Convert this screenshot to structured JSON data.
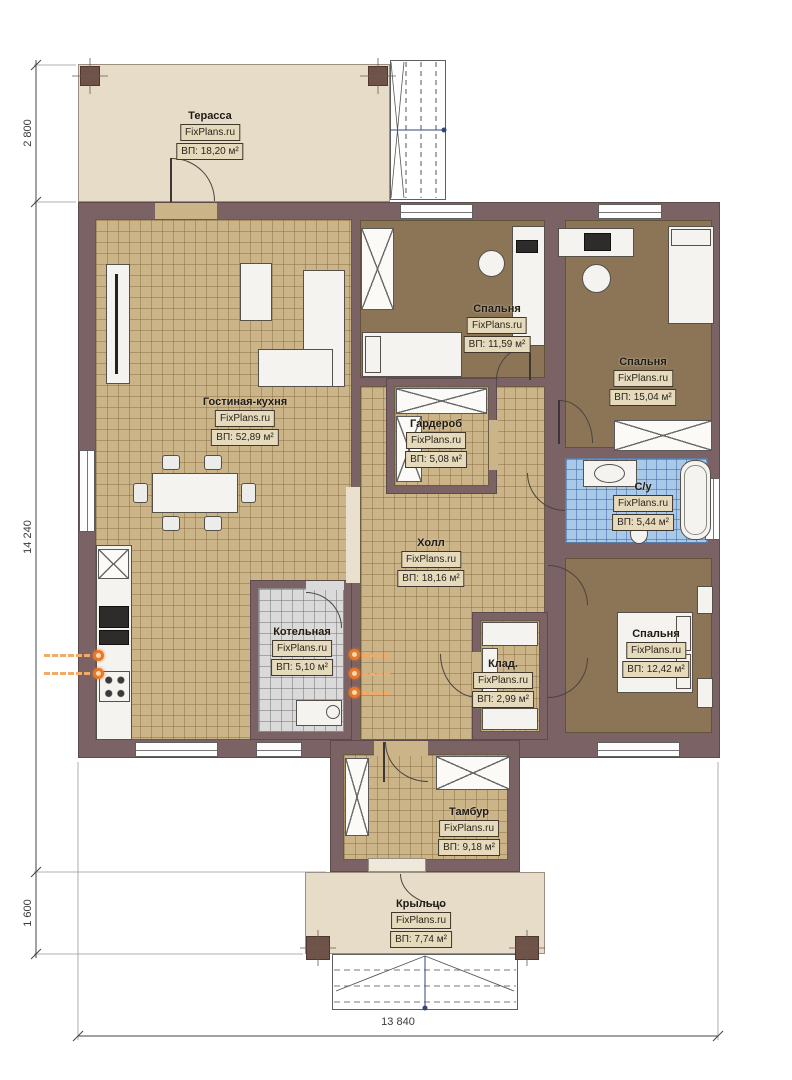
{
  "site": "FixPlans.ru",
  "rooms": [
    {
      "id": "terrace",
      "name": "Терасса",
      "area": "ВП: 18,20 м²"
    },
    {
      "id": "living",
      "name": "Гостиная-кухня",
      "area": "ВП: 52,89 м²"
    },
    {
      "id": "bedroom1",
      "name": "Спальня",
      "area": "ВП: 11,59 м²"
    },
    {
      "id": "bedroom2",
      "name": "Спальня",
      "area": "ВП: 15,04 м²"
    },
    {
      "id": "wardrobe",
      "name": "Гардероб",
      "area": "ВП: 5,08 м²"
    },
    {
      "id": "bathroom",
      "name": "С/у",
      "area": "ВП: 5,44 м²"
    },
    {
      "id": "hall",
      "name": "Холл",
      "area": "ВП: 18,16 м²"
    },
    {
      "id": "boiler",
      "name": "Котельная",
      "area": "ВП: 5,10 м²"
    },
    {
      "id": "storage",
      "name": "Клад.",
      "area": "ВП: 2,99 м²"
    },
    {
      "id": "bedroom3",
      "name": "Спальня",
      "area": "ВП: 12,42 м²"
    },
    {
      "id": "vestibule",
      "name": "Тамбур",
      "area": "ВП: 9,18 м²"
    },
    {
      "id": "porch",
      "name": "Крыльцо",
      "area": "ВП: 7,74 м²"
    }
  ],
  "dimensions": {
    "left_top": "2 800",
    "left_middle": "14 240",
    "left_bottom": "1 600",
    "bottom": "13 840"
  },
  "colors": {
    "wall": "#7b6264",
    "floor_tan": "#ccb489",
    "floor_brown": "#8b7556",
    "floor_blue": "#a9c9e8",
    "floor_gray": "#dadada",
    "deck": "#e7dcc8",
    "utility_accent": "#e8792a",
    "label_box_bg": "#e6dabd"
  }
}
